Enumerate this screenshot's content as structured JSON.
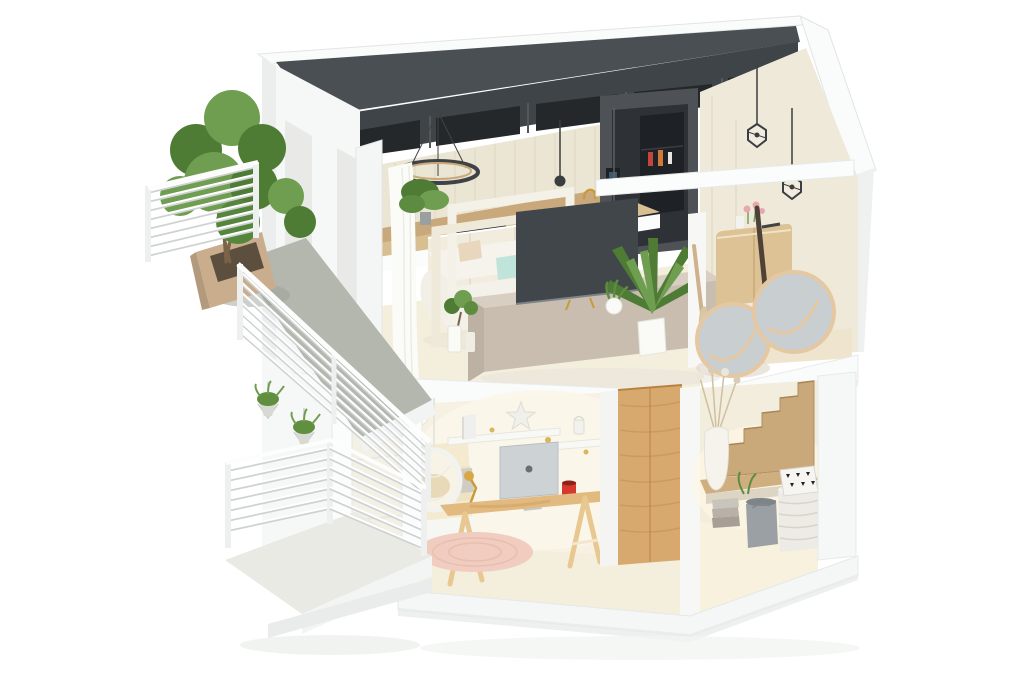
{
  "scene": {
    "type": "3d-isometric-dollhouse-cutaway-render",
    "description": "Cutaway 3D floor-plan render of a two-storey apartment with left-side terraces",
    "floors": [
      {
        "name": "Upper floor",
        "rooms": [
          {
            "name": "Kitchen",
            "items": [
              "dark upper cabinets",
              "ribbed cream backsplash",
              "timber splashback",
              "induction cooktop",
              "sink with gold faucet",
              "black ring chandelier",
              "cone pendant",
              "smart fridge with glass door",
              "cream tall cabinets",
              "wire cage pendants"
            ]
          },
          {
            "name": "Living room",
            "items": [
              "white fabric sofa",
              "mint cushion",
              "blush cushion",
              "decorative white frames",
              "flat screen TV",
              "taupe media console",
              "potted palm",
              "fern",
              "bonsai in white vase",
              "grass pot",
              "white curtains"
            ]
          },
          {
            "name": "Hallway nook",
            "items": [
              "oak sideboard",
              "pink flowers",
              "decor vases",
              "dark paddle",
              "tan paddle",
              "two round wood-rim mirrors"
            ]
          }
        ]
      },
      {
        "name": "Ground floor",
        "rooms": [
          {
            "name": "Bedroom office",
            "items": [
              "bed with cream bedding",
              "hanging chair",
              "wall shelf with gold dots",
              "star ornament",
              "bookend",
              "small lantern",
              "iMac computer",
              "red pencil cup",
              "gold desk lamp",
              "timber trestle desk",
              "round pink rug",
              "white ball pendant"
            ]
          },
          {
            "name": "Wardrobe",
            "items": [
              "oak wardrobe volume"
            ]
          },
          {
            "name": "Stair hall",
            "items": [
              "timber staircase",
              "timber landing",
              "tall white vase with dried flowers",
              "towel stack",
              "grey bin basket",
              "white woven basket",
              "black-white patterned cushion"
            ]
          }
        ]
      },
      {
        "name": "Exterior",
        "rooms": [
          {
            "name": "Upper terrace",
            "items": [
              "potted tree",
              "timber planter",
              "grey carpet walkway",
              "white slat railing",
              "hanging plant baskets"
            ]
          },
          {
            "name": "Lower balcony",
            "items": [
              "white slat railing",
              "hanging plant baskets",
              "sliding glass doors",
              "white base plinth"
            ]
          }
        ]
      }
    ]
  },
  "palette": {
    "bg": "#ffffff",
    "outer_wall": "#f6f7f7",
    "outer_wall_shade": "#eceeee",
    "edge_line": "#e2e5e5",
    "roof_white": "#fafbfb",
    "roof_dark": "#4a4f53",
    "cabinet_dark": "#3f4448",
    "cabinet_cubby": "#24282b",
    "backsplash_cream": "#ebe5d3",
    "backsplash_wood": "#c9a87c",
    "counter_wood": "#d7bf92",
    "cooktop_dark": "#2f3437",
    "sink_gray": "#5f6468",
    "gold": "#c79b3b",
    "fridge_body": "#4e5257",
    "fridge_door": "#2e3236",
    "wall_cream": "#efe9da",
    "wall_cream_lit": "#f6f1e3",
    "pendant_dark": "#3a3e41",
    "floor_cream": "#f4eedd",
    "floor_wood_pale": "#efe4cd",
    "sofa_white": "#f3f1ea",
    "cushion_teal": "#c0e4da",
    "cushion_blush": "#e2c1ab",
    "frame_cream": "#f3f0e6",
    "tv_dark": "#41464a",
    "console_taupe": "#c9bdb0",
    "console_top": "#d8cec2",
    "plant_dark": "#4e7c35",
    "plant_light": "#6f9e50",
    "pot_white": "#fafaf7",
    "curtain_white": "#fbfbf8",
    "sideboard_oak": "#dcc295",
    "paddle_dark": "#4e4238",
    "paddle_tan": "#cdb28c",
    "mirror_glass": "#c9ced1",
    "mirror_rim": "#e5c8a1",
    "flower_pink": "#e8a7b0",
    "band_white": "#fafbfb",
    "bed_linen": "#f4ead0",
    "throw_gray": "#cfccc4",
    "shelf_white": "#f8f8f5",
    "imac_silver": "#cdd2d5",
    "red_accent": "#d6392e",
    "desk_wood": "#e2ba80",
    "rug_pink": "#f0cdc0",
    "wardrobe_oak": "#d7a96f",
    "wardrobe_grain": "#c3914f",
    "stair_wood": "#c9a87a",
    "landing_wood": "#cfae80",
    "vase_white": "#f5f3ec",
    "dried_stem": "#cfc0a0",
    "basket_gray": "#9aa0a3",
    "basket_white": "#edebe5",
    "carpet_gray": "#b4b7ae",
    "railing_white": "#ffffff",
    "railing_shadow": "#ced2d2",
    "planter_wood": "#c9ad8c",
    "trunk_brown": "#7a6348",
    "balcony_floor": "#e9eae4",
    "glass_pale": "#eef1f0",
    "shadow_soft": "#e8eae7"
  }
}
